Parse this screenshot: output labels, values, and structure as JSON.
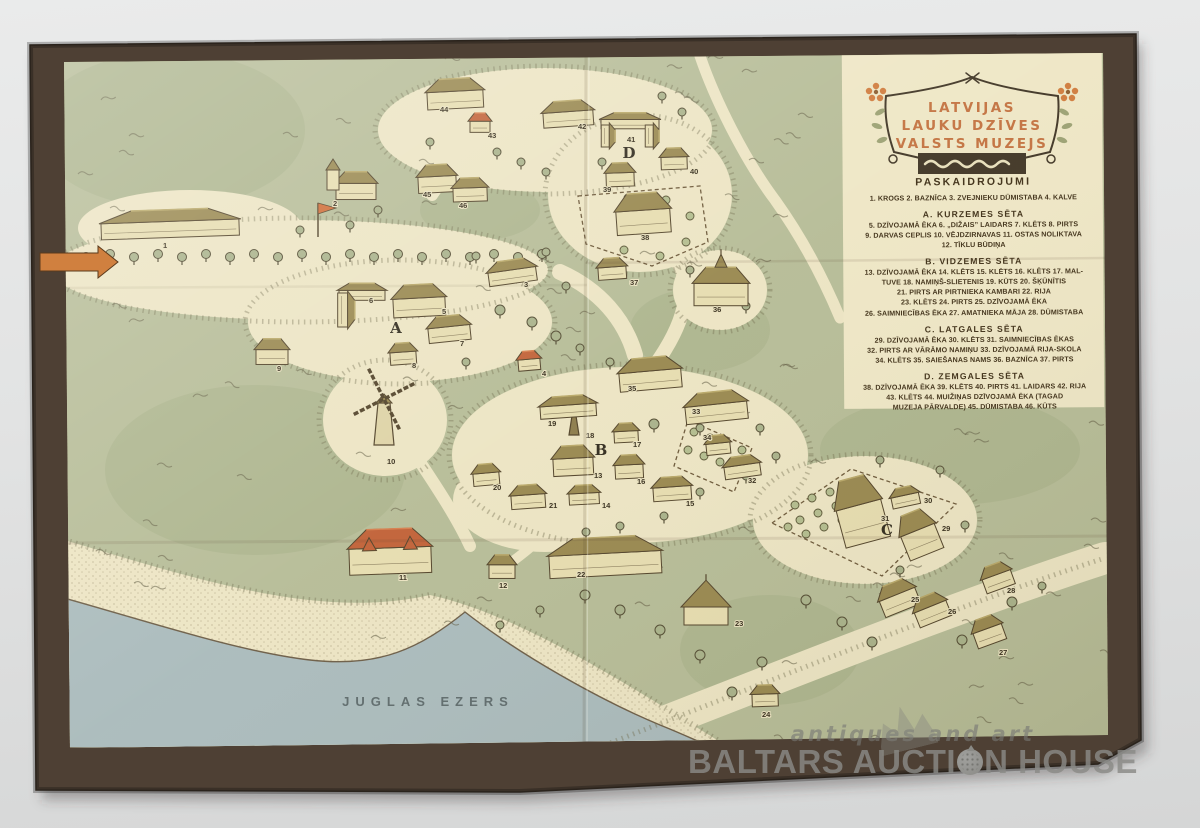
{
  "photo": {
    "background": "#e2e3e3"
  },
  "colors": {
    "cover": "#4e4034",
    "paper": "#eae2bf",
    "green": "#b5bb95",
    "green_dark": "#a8b089",
    "lake": "#a9babb",
    "roof_olive": "#97864c",
    "roof_olive_light": "#b8a766",
    "roof_red": "#c05f34",
    "roof_red_light": "#d67c4a",
    "wall": "#e6dcae",
    "outline": "#4f4026",
    "title_orange": "#c2703d",
    "arrow_orange": "#d0803f",
    "number_ink": "#352c1a"
  },
  "title": {
    "lines": [
      "LATVIJAS",
      "LAUKU DZĪVES",
      "VALSTS MUZEJS"
    ]
  },
  "legend": {
    "heading": "PASKAIDROJUMI",
    "sections": [
      {
        "heading": "",
        "lines": [
          "1. KROGS   2. BAZNĪCA   3. ZVEJNIEKU DŪMISTABA   4. KALVE"
        ]
      },
      {
        "heading": "A. KURZEMES SĒTA",
        "lines": [
          "5. DZĪVOJAMĀ ĒKA   6. „DIŽAIS” LAIDARS   7. KLĒTS   8. PIRTS",
          "9. DARVAS CEPLIS   10. VĒJDZIRNAVAS   11. OSTAS NOLIKTAVA",
          "12. TĪKLU BŪDIŅA"
        ]
      },
      {
        "heading": "B. VIDZEMES SĒTA",
        "lines": [
          "13. DZĪVOJAMĀ ĒKA  14. KLĒTS  15. KLĒTS  16. KLĒTS  17. MAL-",
          "TUVE  18. NAMIŅŠ-SLIETENIS  19. KŪTS  20. ŠĶŪNĪTIS",
          "21. PIRTS AR PIRTNIEKA KAMBARI   22. RIJA",
          "23. KLĒTS   24. PIRTS   25. DZĪVOJAMĀ ĒKA",
          "26. SAIMNIECĪBAS ĒKA  27. AMATNIEKA MĀJA  28. DŪMISTABA"
        ]
      },
      {
        "heading": "C. LATGALES SĒTA",
        "lines": [
          "29. DZĪVOJAMĀ ĒKA   30. KLĒTS   31. SAIMNIECĪBAS ĒKAS",
          "32. PIRTS AR VĀRĀMO NAMIŅU  33. DZĪVOJAMĀ RIJA-SKOLA",
          "34. KLĒTS   35. SAIEŠANAS NAMS   36. BAZNĪCA   37. PIRTS"
        ]
      },
      {
        "heading": "D. ZEMGALES SĒTA",
        "lines": [
          "38. DZĪVOJAMĀ ĒKA  39. KLĒTS  40. PIRTS  41. LAIDARS  42. RIJA",
          "43. KLĒTS   44. MUIŽIŅAS DZĪVOJAMĀ ĒKA (TAGAD",
          "MUZEJA PĀRVALDE)   45. DŪMISTABA   46. KŪTS"
        ]
      }
    ]
  },
  "lake_label": "JUGLAS EZERS",
  "areas": [
    {
      "label": "A",
      "x": 396,
      "y": 333
    },
    {
      "label": "B",
      "x": 601,
      "y": 455
    },
    {
      "label": "C",
      "x": 887,
      "y": 535
    },
    {
      "label": "D",
      "x": 629,
      "y": 158
    }
  ],
  "buildings": [
    {
      "n": 1,
      "x": 170,
      "y": 224,
      "w": 138,
      "h": 26,
      "rot": -2,
      "type": "house",
      "roof": "olive",
      "lx": 163,
      "ly": 248
    },
    {
      "n": 2,
      "x": 356,
      "y": 186,
      "w": 40,
      "h": 26,
      "rot": 0,
      "type": "church",
      "roof": "olive",
      "lx": 333,
      "ly": 206
    },
    {
      "n": 3,
      "x": 512,
      "y": 272,
      "w": 48,
      "h": 22,
      "rot": -8,
      "type": "house",
      "roof": "olive",
      "lx": 524,
      "ly": 287
    },
    {
      "n": 4,
      "x": 529,
      "y": 361,
      "w": 22,
      "h": 18,
      "rot": -5,
      "type": "house",
      "roof": "red",
      "lx": 542,
      "ly": 376
    },
    {
      "n": 5,
      "x": 419,
      "y": 301,
      "w": 52,
      "h": 30,
      "rot": -3,
      "type": "house",
      "roof": "olive",
      "lx": 442,
      "ly": 314
    },
    {
      "n": 6,
      "x": 362,
      "y": 300,
      "w": 46,
      "h": 40,
      "rot": 0,
      "type": "lhouse",
      "roof": "olive",
      "lx": 369,
      "ly": 303
    },
    {
      "n": 7,
      "x": 449,
      "y": 329,
      "w": 42,
      "h": 24,
      "rot": -6,
      "type": "house",
      "roof": "olive",
      "lx": 460,
      "ly": 346
    },
    {
      "n": 8,
      "x": 403,
      "y": 354,
      "w": 26,
      "h": 20,
      "rot": -4,
      "type": "house",
      "roof": "olive",
      "lx": 412,
      "ly": 368
    },
    {
      "n": 9,
      "x": 272,
      "y": 352,
      "w": 32,
      "h": 24,
      "rot": 0,
      "type": "house",
      "roof": "olive",
      "lx": 277,
      "ly": 371
    },
    {
      "n": 10,
      "x": 384,
      "y": 415,
      "w": 30,
      "h": 30,
      "rot": 0,
      "type": "windmill",
      "roof": "olive",
      "lx": 387,
      "ly": 464
    },
    {
      "n": 11,
      "x": 390,
      "y": 552,
      "w": 82,
      "h": 42,
      "rot": -2,
      "type": "redmanor",
      "roof": "red",
      "lx": 399,
      "ly": 580
    },
    {
      "n": 12,
      "x": 502,
      "y": 567,
      "w": 26,
      "h": 22,
      "rot": 0,
      "type": "house",
      "roof": "olive",
      "lx": 499,
      "ly": 588
    },
    {
      "n": 13,
      "x": 573,
      "y": 461,
      "w": 40,
      "h": 28,
      "rot": -3,
      "type": "house",
      "roof": "olive",
      "lx": 594,
      "ly": 478
    },
    {
      "n": 14,
      "x": 584,
      "y": 495,
      "w": 30,
      "h": 18,
      "rot": -3,
      "type": "house",
      "roof": "olive",
      "lx": 602,
      "ly": 508
    },
    {
      "n": 15,
      "x": 672,
      "y": 489,
      "w": 38,
      "h": 22,
      "rot": -4,
      "type": "house",
      "roof": "olive",
      "lx": 686,
      "ly": 506
    },
    {
      "n": 16,
      "x": 629,
      "y": 467,
      "w": 28,
      "h": 22,
      "rot": -3,
      "type": "house",
      "roof": "olive",
      "lx": 637,
      "ly": 484
    },
    {
      "n": 17,
      "x": 626,
      "y": 433,
      "w": 24,
      "h": 18,
      "rot": -3,
      "type": "house",
      "roof": "olive",
      "lx": 633,
      "ly": 447
    },
    {
      "n": 18,
      "x": 574,
      "y": 421,
      "w": 12,
      "h": 30,
      "rot": 0,
      "type": "spire",
      "roof": "olive",
      "lx": 586,
      "ly": 438
    },
    {
      "n": 19,
      "x": 568,
      "y": 407,
      "w": 56,
      "h": 20,
      "rot": -4,
      "type": "house",
      "roof": "olive",
      "lx": 548,
      "ly": 426
    },
    {
      "n": 20,
      "x": 486,
      "y": 475,
      "w": 26,
      "h": 20,
      "rot": -5,
      "type": "house",
      "roof": "olive",
      "lx": 493,
      "ly": 490
    },
    {
      "n": 21,
      "x": 528,
      "y": 497,
      "w": 34,
      "h": 22,
      "rot": -4,
      "type": "house",
      "roof": "olive",
      "lx": 549,
      "ly": 508
    },
    {
      "n": 22,
      "x": 605,
      "y": 557,
      "w": 112,
      "h": 36,
      "rot": -3,
      "type": "house",
      "roof": "olive",
      "lx": 577,
      "ly": 577
    },
    {
      "n": 23,
      "x": 706,
      "y": 609,
      "w": 44,
      "h": 36,
      "rot": 0,
      "type": "pavilion",
      "roof": "olive",
      "lx": 735,
      "ly": 626
    },
    {
      "n": 24,
      "x": 765,
      "y": 696,
      "w": 26,
      "h": 20,
      "rot": -2,
      "type": "house",
      "roof": "olive",
      "lx": 762,
      "ly": 717
    },
    {
      "n": 25,
      "x": 898,
      "y": 597,
      "w": 38,
      "h": 28,
      "rot": -22,
      "type": "house",
      "roof": "olive",
      "lx": 911,
      "ly": 602
    },
    {
      "n": 26,
      "x": 931,
      "y": 609,
      "w": 34,
      "h": 26,
      "rot": -22,
      "type": "house",
      "roof": "olive",
      "lx": 948,
      "ly": 614
    },
    {
      "n": 27,
      "x": 988,
      "y": 631,
      "w": 30,
      "h": 26,
      "rot": -20,
      "type": "house",
      "roof": "olive",
      "lx": 999,
      "ly": 655
    },
    {
      "n": 28,
      "x": 997,
      "y": 577,
      "w": 30,
      "h": 24,
      "rot": -20,
      "type": "house",
      "roof": "olive",
      "lx": 1007,
      "ly": 593
    },
    {
      "n": 29,
      "x": 919,
      "y": 534,
      "w": 36,
      "h": 42,
      "rot": -22,
      "type": "house",
      "roof": "olive",
      "lx": 942,
      "ly": 531
    },
    {
      "n": 30,
      "x": 905,
      "y": 497,
      "w": 28,
      "h": 18,
      "rot": -12,
      "type": "house",
      "roof": "olive",
      "lx": 924,
      "ly": 503
    },
    {
      "n": 31,
      "x": 860,
      "y": 511,
      "w": 46,
      "h": 62,
      "rot": -15,
      "type": "house",
      "roof": "olive",
      "lx": 881,
      "ly": 521
    },
    {
      "n": 32,
      "x": 742,
      "y": 467,
      "w": 36,
      "h": 20,
      "rot": -8,
      "type": "house",
      "roof": "olive",
      "lx": 748,
      "ly": 483
    },
    {
      "n": 33,
      "x": 716,
      "y": 407,
      "w": 62,
      "h": 28,
      "rot": -6,
      "type": "house",
      "roof": "olive",
      "lx": 692,
      "ly": 414
    },
    {
      "n": 34,
      "x": 718,
      "y": 445,
      "w": 24,
      "h": 18,
      "rot": -6,
      "type": "house",
      "roof": "olive",
      "lx": 703,
      "ly": 440
    },
    {
      "n": 35,
      "x": 650,
      "y": 374,
      "w": 62,
      "h": 30,
      "rot": -5,
      "type": "house",
      "roof": "olive",
      "lx": 628,
      "ly": 391
    },
    {
      "n": 36,
      "x": 721,
      "y": 287,
      "w": 54,
      "h": 36,
      "rot": 0,
      "type": "church36",
      "roof": "olive",
      "lx": 713,
      "ly": 312
    },
    {
      "n": 37,
      "x": 612,
      "y": 269,
      "w": 28,
      "h": 20,
      "rot": -4,
      "type": "house",
      "roof": "olive",
      "lx": 630,
      "ly": 285
    },
    {
      "n": 38,
      "x": 643,
      "y": 214,
      "w": 54,
      "h": 38,
      "rot": -4,
      "type": "house",
      "roof": "olive",
      "lx": 641,
      "ly": 240
    },
    {
      "n": 39,
      "x": 620,
      "y": 175,
      "w": 28,
      "h": 22,
      "rot": -2,
      "type": "house",
      "roof": "olive",
      "lx": 603,
      "ly": 192
    },
    {
      "n": 40,
      "x": 674,
      "y": 159,
      "w": 26,
      "h": 20,
      "rot": -2,
      "type": "house",
      "roof": "olive",
      "lx": 690,
      "ly": 174
    },
    {
      "n": 41,
      "x": 630,
      "y": 129,
      "w": 58,
      "h": 30,
      "rot": 0,
      "type": "uhouse",
      "roof": "olive",
      "lx": 627,
      "ly": 142
    },
    {
      "n": 42,
      "x": 568,
      "y": 114,
      "w": 50,
      "h": 24,
      "rot": -4,
      "type": "house",
      "roof": "olive",
      "lx": 578,
      "ly": 129
    },
    {
      "n": 43,
      "x": 480,
      "y": 123,
      "w": 20,
      "h": 18,
      "rot": 0,
      "type": "house",
      "roof": "red",
      "lx": 488,
      "ly": 138
    },
    {
      "n": 44,
      "x": 455,
      "y": 94,
      "w": 56,
      "h": 28,
      "rot": -3,
      "type": "house",
      "roof": "olive",
      "lx": 440,
      "ly": 112
    },
    {
      "n": 45,
      "x": 437,
      "y": 179,
      "w": 38,
      "h": 26,
      "rot": -3,
      "type": "house",
      "roof": "olive",
      "lx": 423,
      "ly": 197
    },
    {
      "n": 46,
      "x": 470,
      "y": 190,
      "w": 34,
      "h": 22,
      "rot": -2,
      "type": "house",
      "roof": "olive",
      "lx": 459,
      "ly": 208
    }
  ],
  "watermark": {
    "tagline": "antiques and art",
    "brand_prefix": "BALTARS AUCTI",
    "brand_suffix": "N HOUSE"
  }
}
